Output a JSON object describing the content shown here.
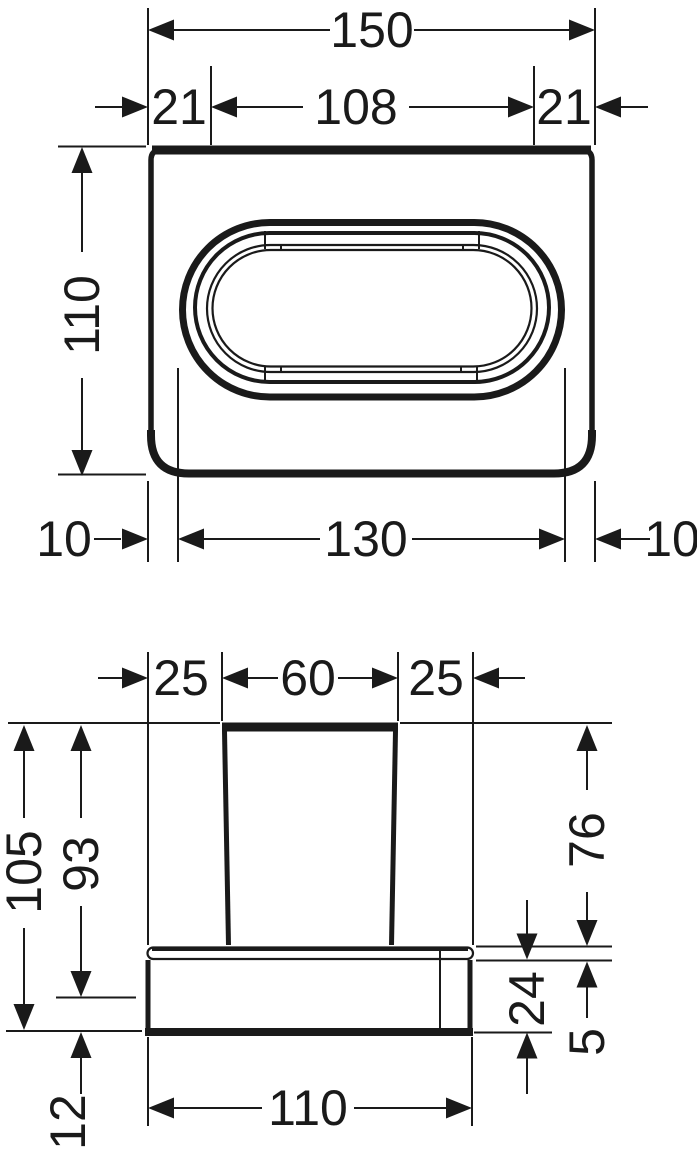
{
  "drawing": {
    "type": "technical dimension drawing",
    "background": "#ffffff",
    "line_color": "#1a1a1a",
    "top_view": {
      "dim_overall_width": "150",
      "dim_offset_left": "21",
      "dim_inner_width": "108",
      "dim_offset_right": "21",
      "dim_height": "110",
      "dim_margin_left": "10",
      "dim_opening_width": "130",
      "dim_margin_right": "10"
    },
    "front_view": {
      "dim_inset_left": "25",
      "dim_cup_width": "60",
      "dim_inset_right": "25",
      "dim_total_height": "105",
      "dim_height_to_base": "93",
      "dim_cup_height": "76",
      "dim_base_height": "24",
      "dim_ledge_thickness": "5",
      "dim_base_width": "110",
      "dim_bottom_offset": "12"
    }
  }
}
